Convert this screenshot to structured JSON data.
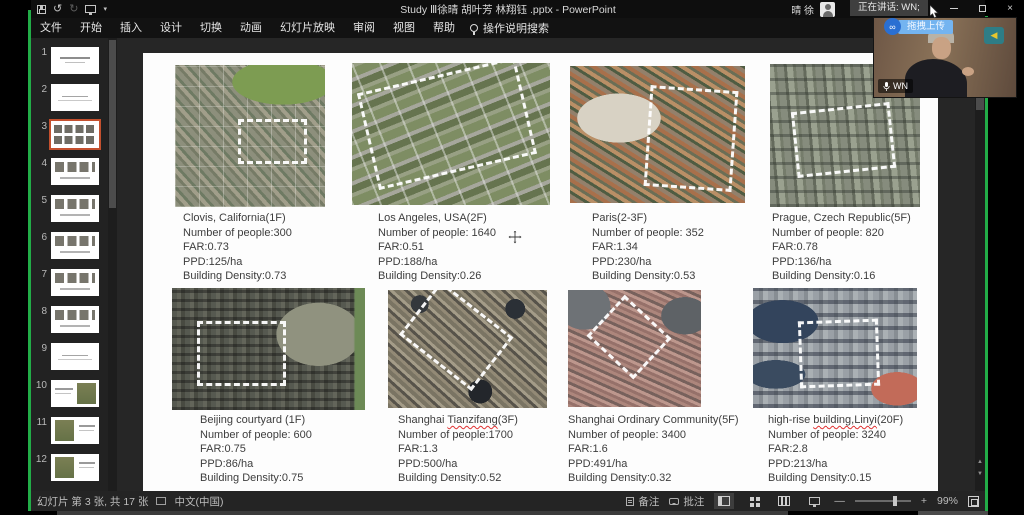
{
  "chrome": {
    "title": "Study Ⅲ徐晴 胡叶芳 林翔钰 .pptx - PowerPoint",
    "user_name": "晴 徐",
    "speaking_indicator": "正在讲话: WN;"
  },
  "icons": {
    "undo": "↺",
    "redo": "↻",
    "caret": "▾",
    "close": "×",
    "zoom_out": "—",
    "zoom_in": "+",
    "prev": "▲",
    "next": "▼",
    "netdisk": "∞",
    "logo_arrow": "◀"
  },
  "menu": {
    "items": [
      {
        "label": "文件"
      },
      {
        "label": "开始"
      },
      {
        "label": "插入"
      },
      {
        "label": "设计"
      },
      {
        "label": "切换"
      },
      {
        "label": "动画"
      },
      {
        "label": "幻灯片放映"
      },
      {
        "label": "审阅"
      },
      {
        "label": "视图"
      },
      {
        "label": "帮助"
      }
    ],
    "search_label": "操作说明搜索"
  },
  "thumbnails": {
    "items": [
      {
        "n": "1",
        "variant": "title"
      },
      {
        "n": "2",
        "variant": "text"
      },
      {
        "n": "3",
        "variant": "cur"
      },
      {
        "n": "4",
        "variant": "imgrow"
      },
      {
        "n": "5",
        "variant": "imgrow"
      },
      {
        "n": "6",
        "variant": "imgrow"
      },
      {
        "n": "7",
        "variant": "imgrow"
      },
      {
        "n": "8",
        "variant": "imgrow"
      },
      {
        "n": "9",
        "variant": "text"
      },
      {
        "n": "10",
        "variant": "map-right"
      },
      {
        "n": "11",
        "variant": "map-left"
      },
      {
        "n": "12",
        "variant": "map-left"
      },
      {
        "n": "13",
        "variant": "imgrow"
      }
    ]
  },
  "slide": {
    "panels": [
      {
        "id": "clovis",
        "loc_pre": "Clovis, California(1F)",
        "loc_mark": "",
        "loc_post": "",
        "people": "Number of people:300",
        "far": "FAR:0.73",
        "ppd": "PPD:125/ha",
        "density": "Building Density:0.73"
      },
      {
        "id": "la",
        "loc_pre": "Los Angeles, USA(2F)",
        "loc_mark": "",
        "loc_post": "",
        "people": "Number of people: 1640",
        "far": "FAR:0.51",
        "ppd": "PPD:188/ha",
        "density": "Building Density:0.26"
      },
      {
        "id": "paris",
        "loc_pre": "Paris(2-3F)",
        "loc_mark": "",
        "loc_post": "",
        "people": "Number of people: 352",
        "far": "FAR:1.34",
        "ppd": "PPD:230/ha",
        "density": "Building Density:0.53"
      },
      {
        "id": "prague",
        "loc_pre": "Prague, Czech Republic(5F)",
        "loc_mark": "",
        "loc_post": "",
        "people": "Number of people: 820",
        "far": "FAR:0.78",
        "ppd": "PPD:136/ha",
        "density": "Building Density:0.16"
      },
      {
        "id": "beijing",
        "loc_pre": "Beijing courtyard (1F)",
        "loc_mark": "",
        "loc_post": "",
        "people": "Number of people: 600",
        "far": "FAR:0.75",
        "ppd": "PPD:86/ha",
        "density": "Building Density:0.75"
      },
      {
        "id": "tianzifang",
        "loc_pre": "Shanghai ",
        "loc_mark": "Tianzifang",
        "loc_post": "(3F)",
        "people": "Number of people:1700",
        "far": "FAR:1.3",
        "ppd": "PPD:500/ha",
        "density": "Building Density:0.52"
      },
      {
        "id": "shcommunity",
        "loc_pre": "Shanghai Ordinary Community(5F)",
        "loc_mark": "",
        "loc_post": "",
        "people": "Number of people: 3400",
        "far": "FAR:1.6",
        "ppd": "PPD:491/ha",
        "density": "Building Density:0.32"
      },
      {
        "id": "linyi",
        "loc_pre": "high-rise ",
        "loc_mark": "building,Linyi",
        "loc_post": "(20F)",
        "people": "Number of people: 3240",
        "far": "FAR:2.8",
        "ppd": "PPD:213/ha",
        "density": "Building Density:0.15"
      }
    ]
  },
  "status": {
    "left": "幻灯片 第 3 张, 共 17 张",
    "lang": "中文(中国)",
    "notes": "备注",
    "comments": "批注",
    "zoom": "99%"
  },
  "meeting": {
    "upload_label": "拖拽上传",
    "mic_label": "WN"
  },
  "colors": {
    "share_border_green": "#22ac47",
    "selected_slide_border": "#c4502e",
    "upload_blue": "#74b4f0",
    "netdisk_blue": "#2a6fd2",
    "spellcheck_red": "#e03131"
  }
}
